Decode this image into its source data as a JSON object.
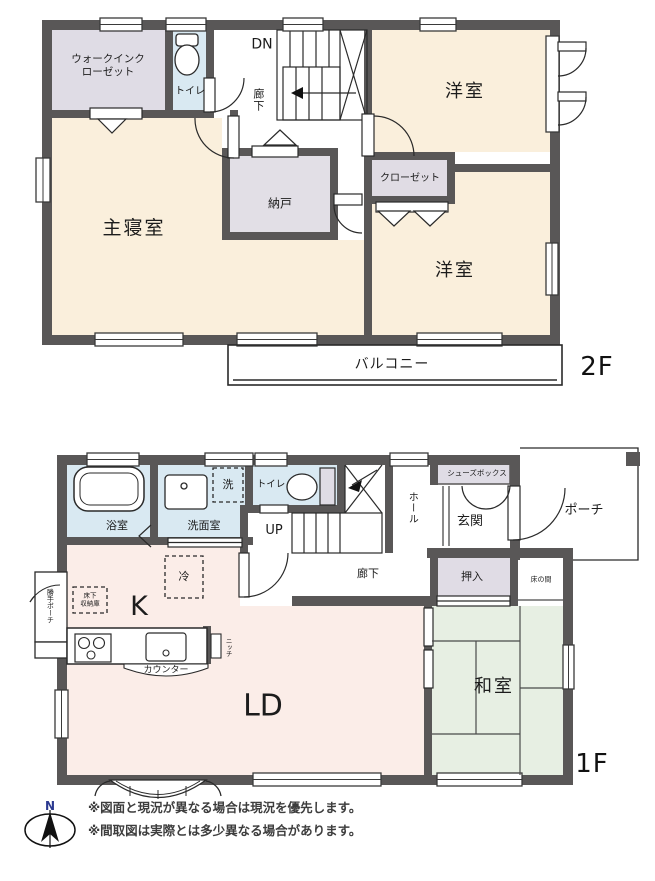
{
  "floor2": {
    "floor_label": "2F",
    "rooms": {
      "walk_in_closet": "ウォークインクローゼット",
      "toilet": "トイレ",
      "stairs_down": "DN",
      "hallway": "廊下",
      "bedroom_top": "洋室",
      "closet": "クローゼット",
      "storage_room": "納戸",
      "master_bedroom": "主寝室",
      "bedroom_bottom": "洋室",
      "balcony": "バルコニー"
    }
  },
  "floor1": {
    "floor_label": "1F",
    "rooms": {
      "bathroom": "浴室",
      "washroom": "洗面室",
      "laundry": "洗",
      "toilet": "トイレ",
      "stairs_up": "UP",
      "hall": "ホール",
      "shoe_box": "シューズボックス",
      "entrance": "玄関",
      "porch": "ポーチ",
      "hallway": "廊下",
      "futon_closet": "押入",
      "tokonoma": "床の間",
      "kitchen": "K",
      "fridge": "冷",
      "underfloor_storage": "床下\n収納庫",
      "counter": "カウンター",
      "niche": "ニッチ",
      "living_dining": "LD",
      "japanese_room": "和室",
      "back_porch": "勝手ポーチ"
    }
  },
  "compass": {
    "north_label": "N"
  },
  "notes": {
    "line1": "※図面と現況が異なる場合は現況を優先します。",
    "line2": "※間取図は実際とは多少異なる場合があります。"
  },
  "colors": {
    "wall": "#595757",
    "room_cream": "#FAEFDC",
    "room_pink": "#FBEDE8",
    "room_blue": "#D9E9F2",
    "room_lavender": "#DFDCE5",
    "room_gray": "#E2DFE6",
    "room_tatami": "#E7EFE3",
    "north_text": "#2b3990"
  }
}
